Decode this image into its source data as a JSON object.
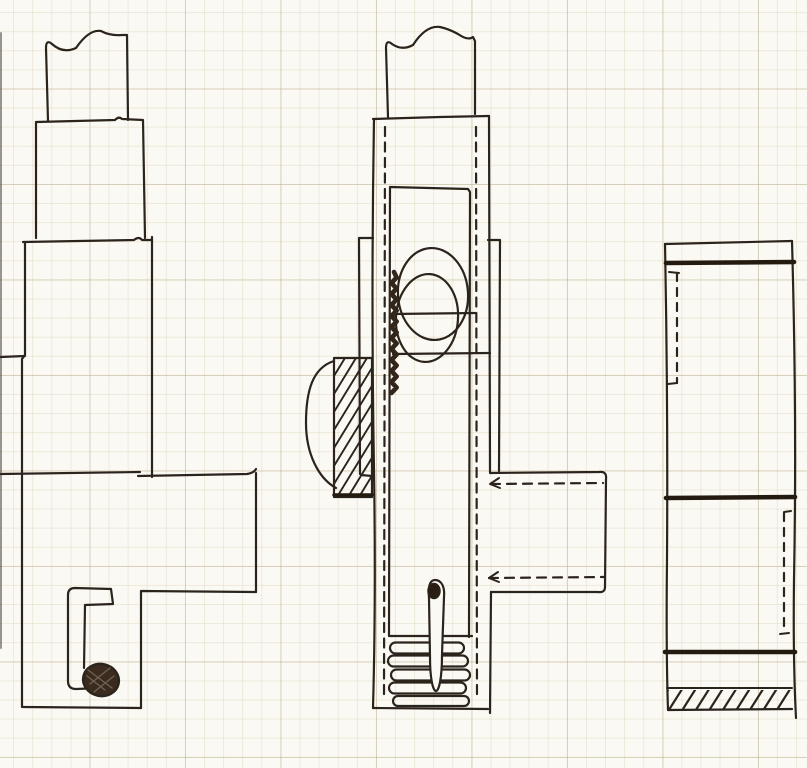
{
  "meta": {
    "description": "Hand-drawn ink sketch on faint graph paper: three sectional elevation views of a mechanical assembly (left stepped housing with pivot pin, center body with cam lobes, hatched block, spring coil and pin, right plate with dark bands and hatched base).",
    "visible_text": []
  },
  "canvas": {
    "width": 807,
    "height": 768
  },
  "drawing": {
    "palette": {
      "paper": "#fbf9f3",
      "ink": "#2b241c",
      "ink_heavy": "#241b10",
      "ink_fill": "#3a2b1e"
    },
    "figures": [
      {
        "name": "left-view",
        "elements": [
          {
            "type": "path",
            "name": "upper-column-outline",
            "d": "M 48 121 L 46 48 Q 46 39 52 44 Q 63 54 76 48 Q 89 29 101 31 Q 110 36 122 35 L 127 35 L 128 120"
          },
          {
            "type": "path",
            "name": "block-2-outline",
            "d": "M 36 238 L 36 122 L 115 120 Q 119 116 122 119 L 143 120 L 145 238"
          },
          {
            "type": "path",
            "name": "block-3-top",
            "d": "M 23 242 L 134 240 Q 139 236 142 240 L 152 240"
          },
          {
            "type": "path",
            "name": "block-3-right-edge",
            "d": "M 152 237 L 152 477"
          },
          {
            "type": "path",
            "name": "block-3-left-edge",
            "d": "M 25 242 L 25 355 L 22 359 L 22 473"
          },
          {
            "type": "path",
            "name": "left-step-tick",
            "d": "M 0 357 L 25 356"
          },
          {
            "type": "path",
            "name": "base-top-line",
            "d": "M 0 474 L 140 472"
          },
          {
            "type": "path",
            "name": "base-top-line-right",
            "d": "M 138 476 L 247 474 Q 254 473 256 469"
          },
          {
            "type": "path",
            "name": "base-right-edge",
            "d": "M 256 473 L 256 592"
          },
          {
            "type": "path",
            "name": "base-step",
            "d": "M 256 592 L 141 591 L 141 708"
          },
          {
            "type": "path",
            "name": "base-bottom",
            "d": "M 141 708 L 23 707"
          },
          {
            "type": "path",
            "name": "base-left-edge",
            "d": "M 22 473 L 22 707"
          },
          {
            "type": "path",
            "name": "hook-channel-outer",
            "d": "M 111 589 L 75 588 Q 68 588 68 595 L 68 681 Q 68 689 76 689 L 100 688"
          },
          {
            "type": "path",
            "name": "hook-channel-inner",
            "d": "M 111 589 L 113 604 L 85 605 L 84 668"
          },
          {
            "type": "ellipse",
            "name": "pivot-dot",
            "cx": 101,
            "cy": 680,
            "rx": 18,
            "ry": 16,
            "rot": 12,
            "fill": "#3a2b1e",
            "sw": 2.4
          },
          {
            "type": "path",
            "name": "pivot-dot-texture",
            "d": "M 88 670 L 112 688 M 90 684 L 110 668 M 94 692 L 114 676 M 87 676 L 105 690",
            "sw": 1.4,
            "color": "rgba(245,240,228,0.28)"
          }
        ]
      },
      {
        "name": "center-view",
        "elements": [
          {
            "type": "path",
            "name": "upper-column-outline",
            "d": "M 388 117 L 386 48 Q 386 39 392 44 Q 402 51 413 45 Q 426 25 440 27 Q 449 29 458 34 Q 468 41 473 37 L 475 41 L 475 114"
          },
          {
            "type": "path",
            "name": "body-top",
            "d": "M 373 119 L 440 117 L 489 116"
          },
          {
            "type": "path",
            "name": "body-left-edge",
            "d": "M 374 119 Q 371 300 374 470 Q 376 600 373 708"
          },
          {
            "type": "path",
            "name": "body-bottom",
            "d": "M 373 708 L 488 709"
          },
          {
            "type": "path",
            "name": "body-right-edge-upper",
            "d": "M 489 116 L 490 472"
          },
          {
            "type": "path",
            "name": "body-right-edge-lower",
            "d": "M 491 592 L 490 713"
          },
          {
            "type": "path",
            "name": "hidden-line-left",
            "d": "M 385 127 L 384 700",
            "dash": [
              9,
              6.5
            ]
          },
          {
            "type": "path",
            "name": "hidden-line-right",
            "d": "M 476 127 L 477 700",
            "dash": [
              9,
              6.5
            ]
          },
          {
            "type": "path",
            "name": "left-flange",
            "d": "M 373 238 L 359 238 L 360 474"
          },
          {
            "type": "path",
            "name": "right-flange",
            "d": "M 488 240 L 500 240 L 499 471"
          },
          {
            "type": "path",
            "name": "inner-window",
            "d": "M 390 187 L 468 189 L 470 192 L 469 637 M 390 187 L 389 636 M 389 636 L 472 636"
          },
          {
            "type": "ellipse",
            "name": "cam-lobe-upper",
            "cx": 433,
            "cy": 294,
            "rx": 35,
            "ry": 46,
            "rot": -4,
            "sw": 2.2
          },
          {
            "type": "ellipse",
            "name": "cam-lobe-lower",
            "cx": 427,
            "cy": 318,
            "rx": 31,
            "ry": 44,
            "rot": 4,
            "sw": 2.2
          },
          {
            "type": "path",
            "name": "cam-section-line-1",
            "d": "M 392 314 L 476 313"
          },
          {
            "type": "path",
            "name": "cam-section-line-2",
            "d": "M 393 354 L 490 353"
          },
          {
            "type": "squiggle",
            "name": "weld-scribble",
            "x": 394,
            "y1": 272,
            "y2": 396,
            "amp": 2.6,
            "step": 5.5,
            "sw": 4.6,
            "color": "#32251a"
          },
          {
            "type": "hatch",
            "name": "hatch-block-fill",
            "x": 334,
            "y": 358,
            "w": 38,
            "h": 139,
            "spacing": 11,
            "run": 85,
            "sw": 1.9
          },
          {
            "type": "path",
            "name": "hatch-block-outline",
            "d": "M 334 358 L 372 358 L 372 497 L 334 497 Z"
          },
          {
            "type": "path",
            "name": "hatch-block-step",
            "d": "M 361 475 L 372 476"
          },
          {
            "type": "path",
            "name": "hatch-block-base",
            "d": "M 334 495 L 372 495",
            "sw": 3.4,
            "color": "#241b10"
          },
          {
            "type": "path",
            "name": "side-bump-arc",
            "d": "M 334 361 C 312 368 306 392 306 423 C 306 453 318 478 336 488"
          },
          {
            "type": "path",
            "name": "side-arm-outline",
            "d": "M 490 473 L 599 472 Q 607 471 606 479 L 605 587 Q 605 593 598 592 L 491 592"
          },
          {
            "type": "path",
            "name": "side-arm-hidden-top",
            "d": "M 491 484 L 603 483",
            "dash": [
              9,
              7
            ]
          },
          {
            "type": "path",
            "name": "side-arm-hidden-bottom",
            "d": "M 489 578 L 605 577",
            "dash": [
              9,
              7
            ]
          },
          {
            "type": "path",
            "name": "arrow-top",
            "d": "M 499 478 L 490 484 L 500 488",
            "sw": 2
          },
          {
            "type": "path",
            "name": "arrow-bottom",
            "d": "M 498 572 L 489 578 L 499 582",
            "sw": 2
          },
          {
            "type": "capsule",
            "name": "spring-coil-1",
            "x1": 390,
            "x2": 464,
            "cy": 648,
            "r": 5.5
          },
          {
            "type": "capsule",
            "name": "spring-coil-2",
            "x1": 388,
            "x2": 468,
            "cy": 661,
            "r": 5.5
          },
          {
            "type": "capsule",
            "name": "spring-coil-3",
            "x1": 391,
            "x2": 470,
            "cy": 675,
            "r": 5.5
          },
          {
            "type": "capsule",
            "name": "spring-coil-4",
            "x1": 389,
            "x2": 466,
            "cy": 688,
            "r": 5.5
          },
          {
            "type": "capsule",
            "name": "spring-coil-5",
            "x1": 393,
            "x2": 469,
            "cy": 701,
            "r": 5
          },
          {
            "type": "path",
            "name": "pin-outline",
            "d": "M 429 598 C 428 586 430 580 435 580 C 441 580 445 586 444 597 L 442 655 C 442 678 439 691 436 691 C 433 691 430 679 430 657 Z",
            "fill": "paper",
            "sw": 2.2
          },
          {
            "type": "ellipse",
            "name": "pin-head",
            "cx": 434,
            "cy": 591,
            "rx": 6,
            "ry": 7.5,
            "fill": "#2a1d12",
            "sw": 1.5
          }
        ]
      },
      {
        "name": "right-view",
        "elements": [
          {
            "type": "path",
            "name": "outer-top",
            "d": "M 665 244 L 792 241"
          },
          {
            "type": "path",
            "name": "outer-left-edge",
            "d": "M 665 244 Q 668 400 667 560 Q 666 650 668 710"
          },
          {
            "type": "path",
            "name": "outer-right-edge",
            "d": "M 792 241 Q 797 420 794 580 Q 793 660 796 718"
          },
          {
            "type": "path",
            "name": "outer-bottom",
            "d": "M 668 710 L 792 709"
          },
          {
            "type": "path",
            "name": "band-top",
            "d": "M 666 263 L 794 262",
            "sw": 4.6,
            "color": "#241b10"
          },
          {
            "type": "path",
            "name": "hidden-left",
            "d": "M 677 273 L 677 383",
            "dash": [
              8,
              7
            ]
          },
          {
            "type": "path",
            "name": "hidden-left-ticks",
            "d": "M 669 272 L 679 273 M 668 384 L 677 383",
            "sw": 2
          },
          {
            "type": "path",
            "name": "band-middle",
            "d": "M 666 498 L 795 497",
            "sw": 4.6,
            "color": "#241b10"
          },
          {
            "type": "path",
            "name": "hidden-right",
            "d": "M 784 513 L 784 633",
            "dash": [
              8,
              7
            ]
          },
          {
            "type": "path",
            "name": "hidden-right-ticks",
            "d": "M 784 512 L 791 511 M 780 634 L 789 633",
            "sw": 2
          },
          {
            "type": "path",
            "name": "band-lower",
            "d": "M 665 652 L 795 652",
            "sw": 4.6,
            "color": "#241b10"
          },
          {
            "type": "path",
            "name": "hatch-band-top",
            "d": "M 667 688 L 792 688",
            "sw": 2
          },
          {
            "type": "hatch",
            "name": "hatch-band-fill",
            "x": 668,
            "y": 690,
            "w": 123,
            "h": 19,
            "spacing": 13.5,
            "run": 12,
            "sw": 2.2
          }
        ]
      },
      {
        "name": "scan-artifacts",
        "elements": [
          {
            "type": "path",
            "name": "scan-edge-left",
            "d": "M 1 33 L 1 648",
            "sw": 2,
            "color": "rgba(58,48,38,0.5)"
          }
        ]
      }
    ]
  }
}
